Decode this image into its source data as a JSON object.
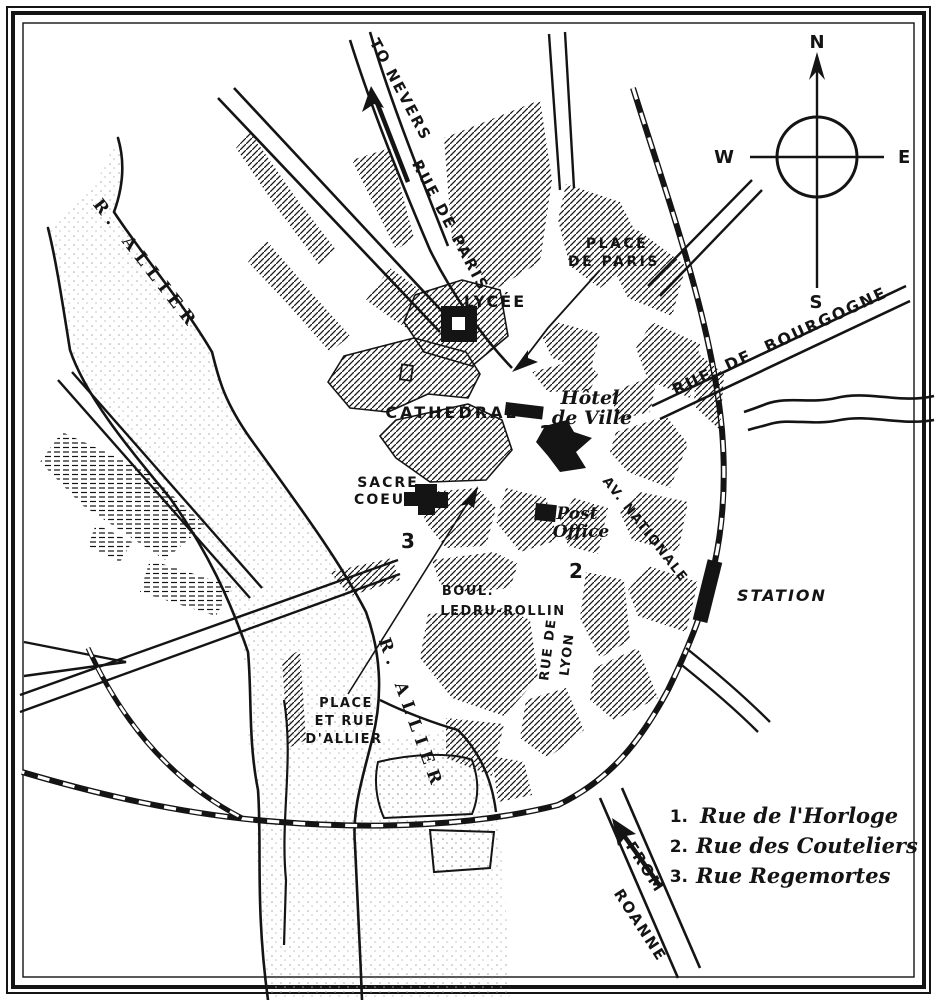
{
  "title": "City map of Moulins",
  "compass": {
    "n": "N",
    "s": "S",
    "e": "E",
    "w": "W"
  },
  "roads": {
    "to_nevers": "TO NEVERS",
    "rue_de_paris": "RUE DE PARIS",
    "rue_de_bourgogne": "RUE DE BOURGOGNE",
    "av_nationale": "AV. NATIONALE",
    "boul": "BOUL.",
    "ledru_rollin": "LEDRU-ROLLIN",
    "rue_de": "RUE DE",
    "lyon": "LYON",
    "from": "FROM",
    "roanne": "ROANNE"
  },
  "river": {
    "label_upper": "R. ALLIER",
    "label_lower": "R. ALLIER"
  },
  "places": {
    "place_de_paris_line1": "PLACE",
    "place_de_paris_line2": "DE PARIS",
    "lycee": "LYCÉE",
    "cathedral": "CATHEDRAL",
    "hotel_de_ville_line1": "Hôtel",
    "hotel_de_ville_line2": "de Ville",
    "sacre_line1": "SACRE",
    "sacre_line2": "COEUR",
    "post_line1": "Post",
    "post_line2": "Office",
    "station": "STATION",
    "place_allier_line1": "PLACE",
    "place_allier_line2": "ET RUE",
    "place_allier_line3": "D'ALLIER"
  },
  "markers": {
    "m1": "1",
    "m2": "2",
    "m3": "3"
  },
  "legend": [
    {
      "num": "1.",
      "name": "Rue de l'Horloge"
    },
    {
      "num": "2.",
      "name": "Rue des Couteliers"
    },
    {
      "num": "3.",
      "name": "Rue Regemortes"
    }
  ],
  "colors": {
    "ink": "#141414",
    "paper": "#ffffff"
  }
}
